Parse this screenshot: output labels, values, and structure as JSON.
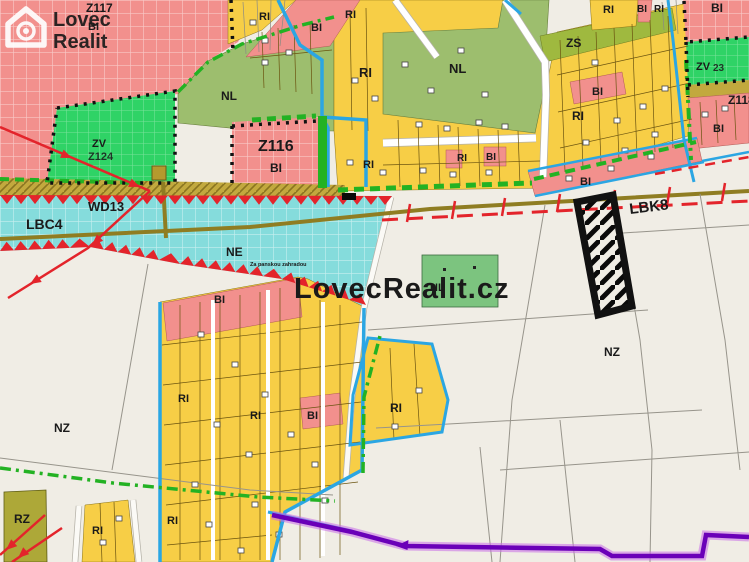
{
  "branding": {
    "logo_line1": "Lovec",
    "logo_line2": "Realit",
    "watermark": "LovecRealit.cz"
  },
  "labels": {
    "z117": "Z117",
    "z117_bi": "BI",
    "ri_nw": "RI",
    "bi_n": "BI",
    "ri_n": "RI",
    "nl_w": "NL",
    "ri_main_n": "RI",
    "nl_n": "NL",
    "zs": "ZS",
    "ri_ne1": "RI",
    "bi_ne1": "BI",
    "ri_ne2": "RI",
    "bi_ne_big": "BI",
    "zv_ne": "ZV",
    "zv_ne_code": "23",
    "z118": "Z118",
    "bi_e": "BI",
    "z116": "Z116",
    "z116_bi": "BI",
    "zv_w": "ZV",
    "zv_w_code": "Z124",
    "ri_ms1": "RI",
    "ri_ms2": "RI",
    "bi_ms": "BI",
    "bi_band_e": "BI",
    "ri_e_blk": "RI",
    "bi_road": "BI",
    "wd13": "WD13",
    "lbc4": "LBC4",
    "ne": "NE",
    "street": "Za panskou zahradou",
    "lbk8": "LBK8",
    "nl_parcel": "NL",
    "nz_e": "NZ",
    "nz_w": "NZ",
    "rz": "RZ",
    "bi_c": "BI",
    "ri_cw": "RI",
    "ri_cm": "RI",
    "bi_ce": "BI",
    "ri_arm": "RI",
    "ri_sw1": "RI",
    "ri_sw2": "RI"
  },
  "colors": {
    "residential-pink": "#F2908D",
    "recreation-yellow": "#F7CE46",
    "forest-green": "#9DBE6E",
    "park-green": "#2FD366",
    "meadow-green": "#7CC47F",
    "water-cyan": "#85DCDC",
    "farmland-beige": "#F0EDE5",
    "orchard-olive": "#ADA838",
    "zs-olive": "#9FB93F",
    "hazard-red": "#E3242B",
    "utility-blue": "#2BA6E3",
    "nature-green": "#23B223",
    "road-khaki": "#8F7D22",
    "strip-khaki": "#C2A93E",
    "easement-purple": "#6A00B8",
    "easement-glow": "#C86CE8",
    "highlight-black": "#111111"
  }
}
